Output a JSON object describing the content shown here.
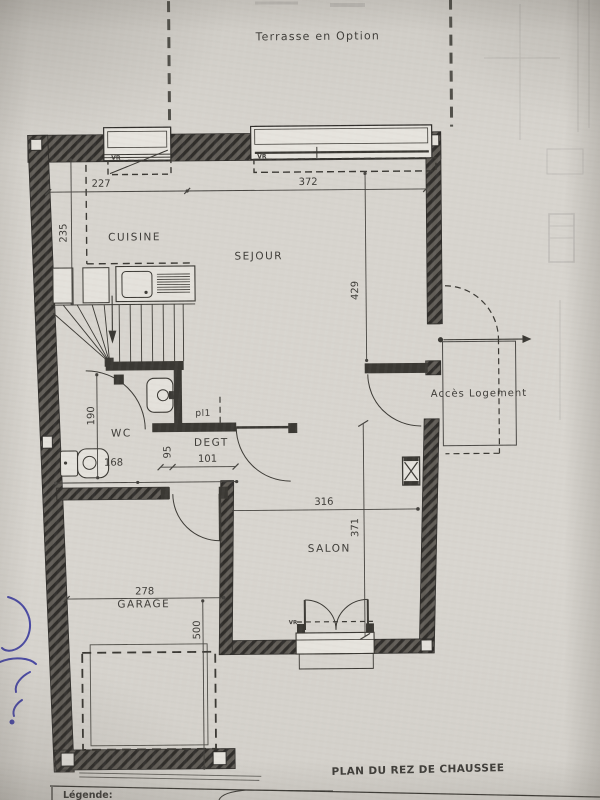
{
  "photo": {
    "terrace_label": "Terrasse en Option",
    "plan_title": "PLAN DU REZ DE CHAUSSEE",
    "legend_title": "Légende:"
  },
  "rooms": {
    "cuisine": "CUISINE",
    "sejour": "SEJOUR",
    "wc": "WC",
    "degagement": "DEGT",
    "placard": "pl1",
    "salon": "SALON",
    "garage": "GARAGE",
    "access": "Accès Logement"
  },
  "dimensions": {
    "top_left": "227",
    "top_right": "372",
    "cuisine_depth": "235",
    "sejour_depth": "429",
    "wc_depth": "190",
    "wc_width": "168",
    "hall_gap": "95",
    "hall_width": "101",
    "salon_width": "316",
    "salon_depth": "371",
    "garage_width": "278",
    "garage_depth": "500"
  },
  "windows": {
    "vr_cuisine": "VR",
    "vr_sejour": "VR",
    "vr_salon": "VR"
  },
  "colors": {
    "paper": "#d7d4ce",
    "ink": "#3a3833",
    "pen": "#31319b"
  }
}
